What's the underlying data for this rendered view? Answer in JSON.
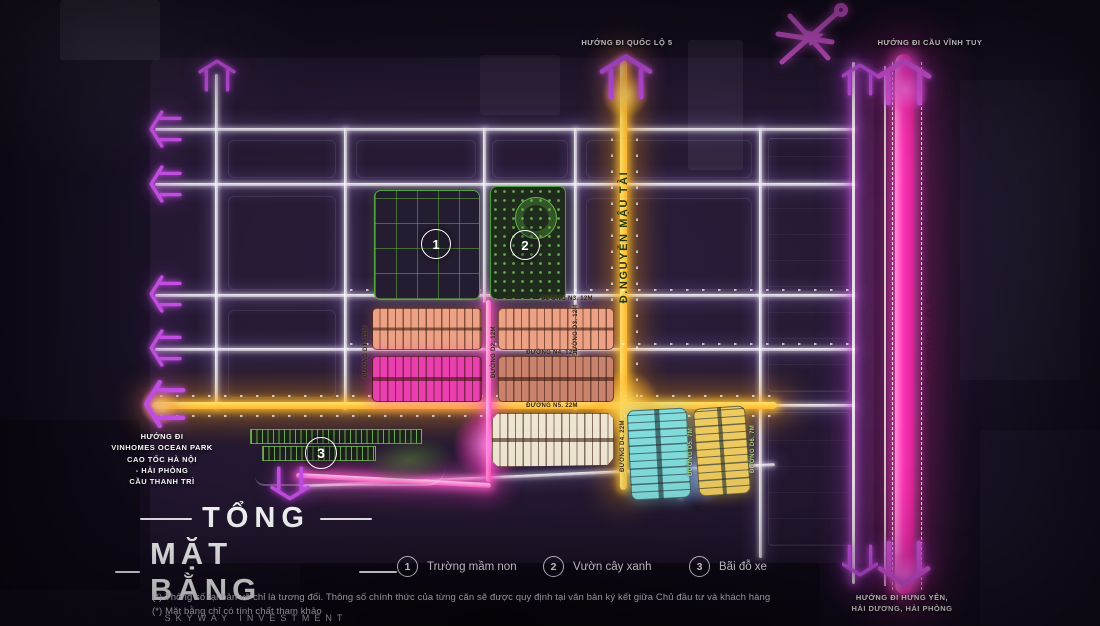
{
  "directions": {
    "top_center": "HƯỚNG ĐI QUỐC LỘ 5",
    "top_right": "HƯỚNG ĐI CẦU VĨNH TUY",
    "left": "HƯỚNG ĐI\nVINHOMES OCEAN PARK\nCAO TỐC HÀ NỘI\n- HẢI PHÒNG\nCẦU THANH TRÌ",
    "bottom_right": "HƯỚNG ĐI HƯNG YÊN,\nHẢI DƯƠNG, HẢI PHÒNG"
  },
  "roads": {
    "nguyen_mau_tai": "Đ.NGUYỄN MẬU TÀI",
    "quoc_lo_5": "Đ.QUỐC LỘ 5",
    "n3": "ĐƯỜNG N3. 12M",
    "n4": "ĐƯỜNG N4. 12M",
    "n5": "ĐƯỜNG N5. 22M",
    "d1": "ĐƯỜNG D1. 12M",
    "d2": "ĐƯỜNG D2. 12M",
    "d3": "ĐƯỜNG D3. 12M",
    "d4": "ĐƯỜNG D4. 22M",
    "d5": "ĐƯỜNG D5. 7M",
    "d6": "ĐƯỜNG D6. 7M"
  },
  "markers": {
    "kindergarten": "1",
    "garden": "2",
    "parking": "3"
  },
  "legend": [
    {
      "num": "1",
      "label": "Trường mầm non"
    },
    {
      "num": "2",
      "label": "Vườn cây xanh"
    },
    {
      "num": "3",
      "label": "Bãi đỗ xe"
    }
  ],
  "title_block": {
    "line1": "TỔNG",
    "line2": "MẶT BẰNG",
    "subtitle": "SKYWAY INVESTMENT"
  },
  "footnotes": {
    "line1": "(*) Thông số tại bản vẽ chỉ là tương đối. Thông số chính thức của từng căn sẽ được quy định tại văn bản ký kết giữa Chủ đầu tư và khách hàng",
    "line2": "(*) Mặt bằng chỉ có tính chất tham khảo"
  },
  "colors": {
    "background": "#150e20",
    "road_yellow": "#ffc43e",
    "road_pink": "#ff37b8",
    "road_white": "#ffffff",
    "arrow_purple": "#c44fe4",
    "block_salmon": "#eda285",
    "block_magenta": "#ea3fae",
    "block_cream": "#efe6d2",
    "block_cyan": "#82dcdc",
    "block_yellow": "#eecb60",
    "greenery": "#5aa63f"
  }
}
